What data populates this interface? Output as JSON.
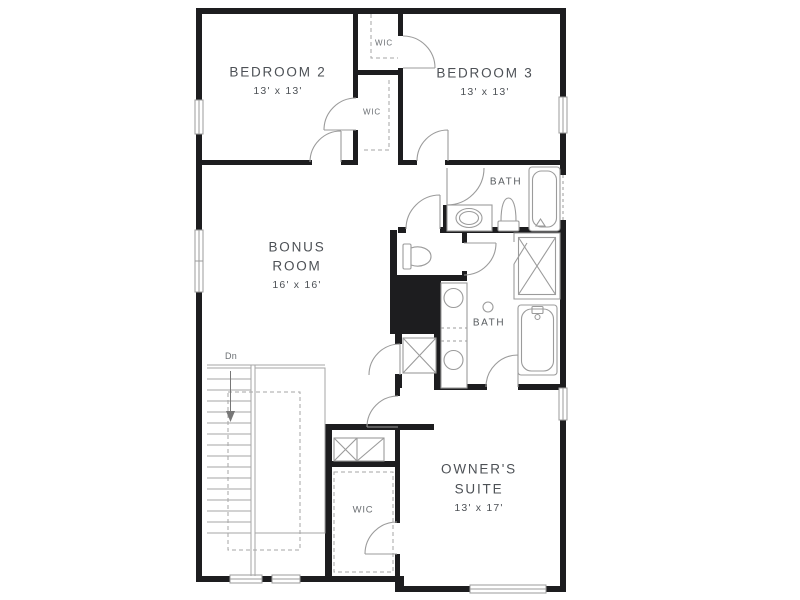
{
  "plan": {
    "rooms": {
      "bedroom2": {
        "name": "BEDROOM 2",
        "dims": "13' x 13'"
      },
      "bedroom3": {
        "name": "BEDROOM 3",
        "dims": "13' x 13'"
      },
      "bonus_room": {
        "name_line1": "BONUS",
        "name_line2": "ROOM",
        "dims": "16' x 16'"
      },
      "owners_suite": {
        "name_line1": "OWNER'S",
        "name_line2": "SUITE",
        "dims": "13' x 17'"
      },
      "bath_upper": {
        "name": "BATH"
      },
      "bath_owner": {
        "name": "BATH"
      },
      "wic_bedroom3": {
        "name": "WIC"
      },
      "wic_bedroom2": {
        "name": "WIC"
      },
      "wic_owner": {
        "name": "WIC"
      },
      "stairs": {
        "label": "Dn"
      }
    },
    "colors": {
      "wall": "#1d1d1f",
      "fixture_line": "#9b9b9b",
      "label_text": "#4d5156",
      "background": "#ffffff"
    }
  }
}
